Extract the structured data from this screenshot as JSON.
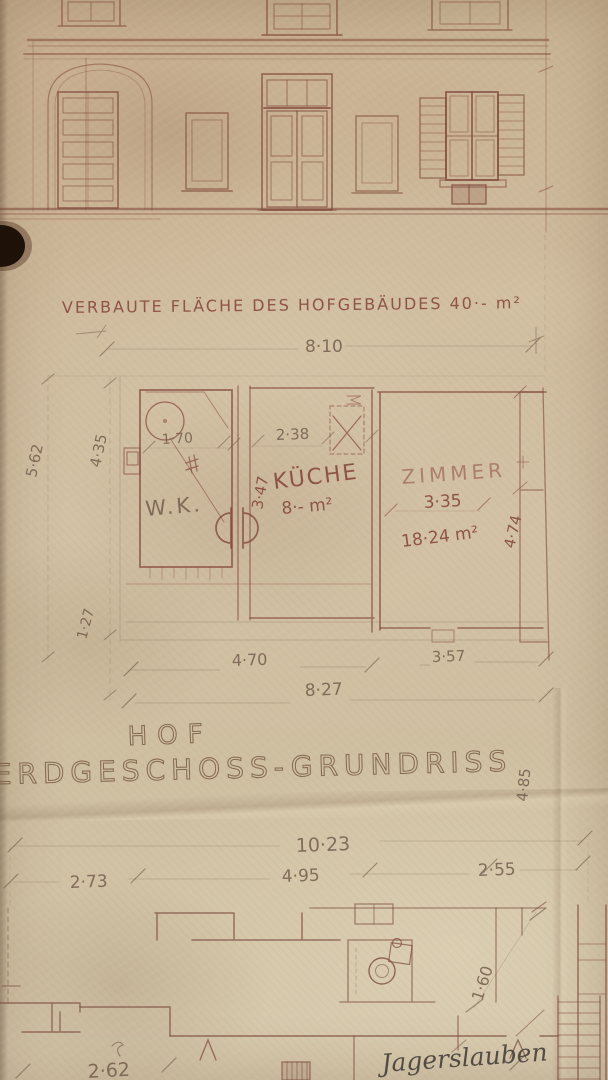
{
  "palette": {
    "paper": "#cdba9c",
    "ink": "#86463a",
    "pencil": "#71594a",
    "graphite": "#45403a"
  },
  "header": {
    "title": "VERBAUTE FLÄCHE DES HOFGEBÄUDES 40·- m²"
  },
  "hof_plan": {
    "dim_total_width": "8·10",
    "dim_left_outer": "5·62",
    "dim_left_inner": "4·35",
    "dim_left_lower": "1·27",
    "wk": {
      "label": "W.K.",
      "dim_width": "1·70"
    },
    "kueche": {
      "label": "KÜCHE",
      "area": "8·- m²",
      "dim_width": "2·38",
      "dim_height": "3·47"
    },
    "zimmer": {
      "label": "ZIMMER",
      "area": "18·24 m²",
      "dim_width": "3·35",
      "dim_height": "4·74"
    },
    "dim_bottom_left": "4·70",
    "dim_bottom_right": "3·57",
    "dim_bottom_total": "8·27",
    "hof_label": "HOF"
  },
  "ground_plan": {
    "caption": "ERDGESCHOSS-GRUNDRISS",
    "caption_side_dim": "4·85",
    "dim_total_width": "10·23",
    "dim_left": "2·73",
    "dim_middle": "4·95",
    "dim_right": "2·55",
    "dim_height_right": "1·60",
    "dim_bottom_left": "2·62",
    "handwritten_note": "Jagerslauben"
  }
}
